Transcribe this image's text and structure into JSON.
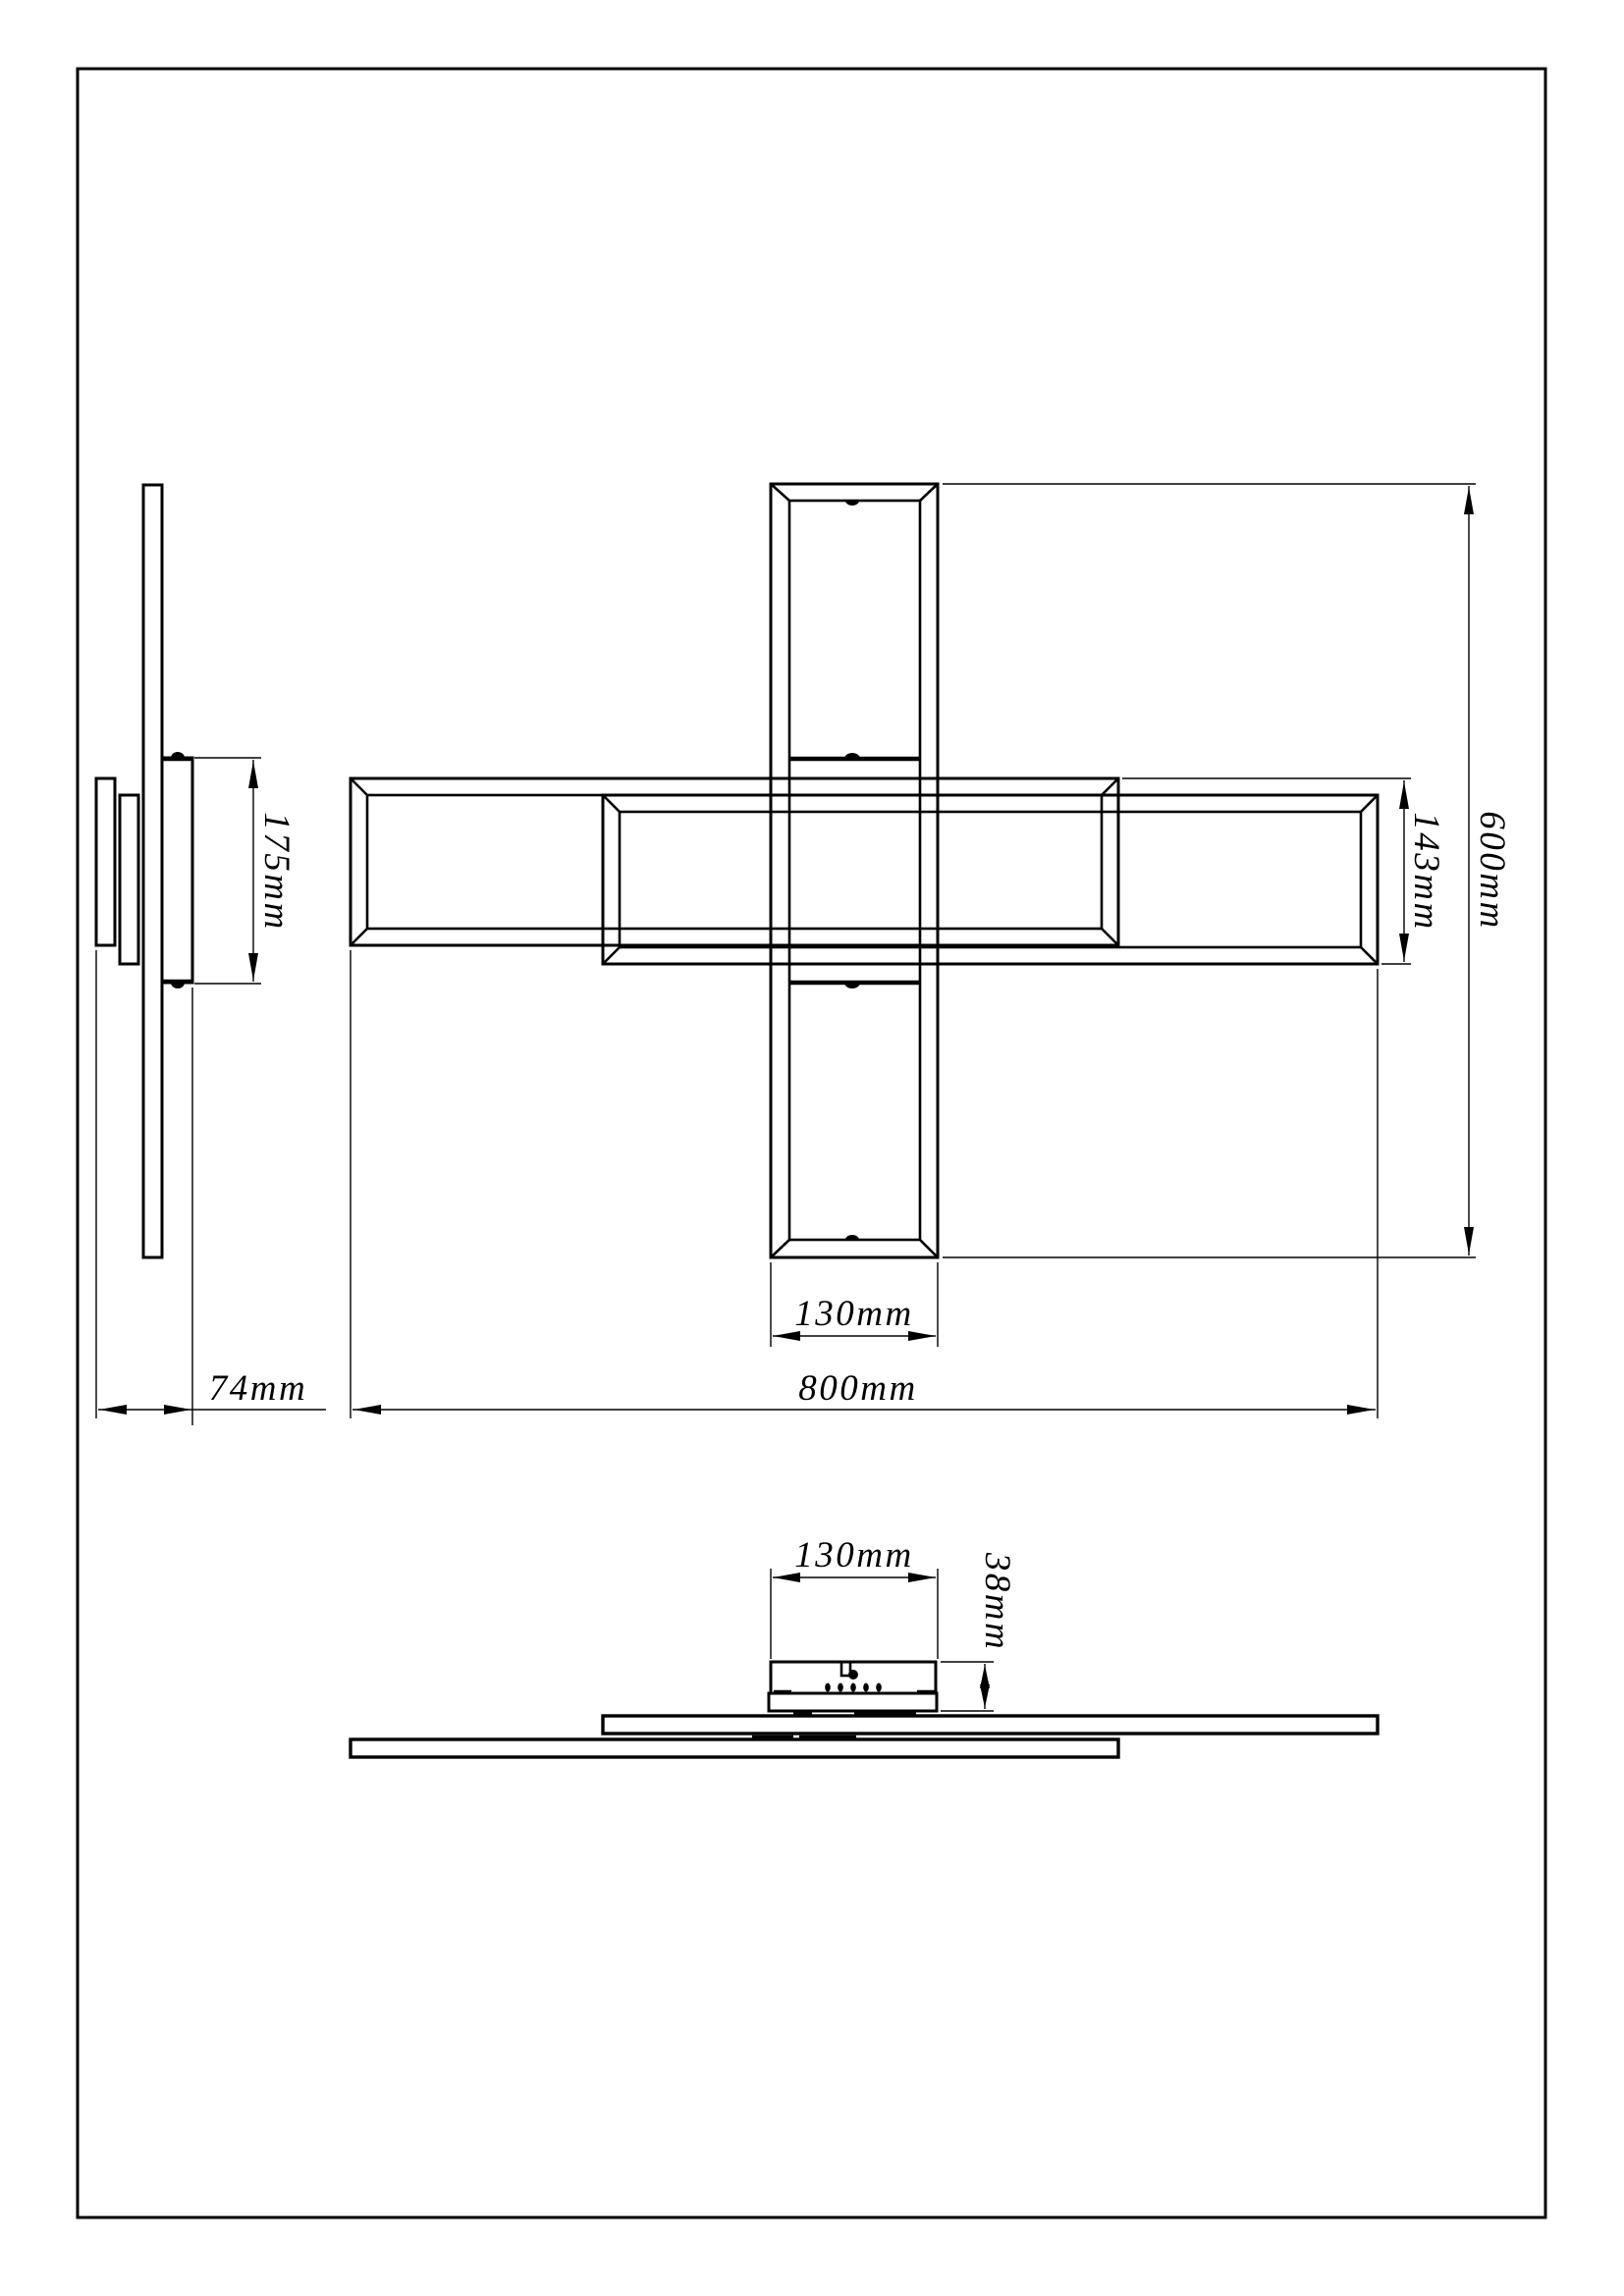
{
  "drawing": {
    "background": "#ffffff",
    "line_color": "#000000",
    "labels": {
      "overall_width": "800mm",
      "overall_height": "600mm",
      "bar_width": "130mm",
      "double_frame_span": "143mm",
      "side_depth": "74mm",
      "side_canopy_span": "175mm",
      "bottom_canopy_width": "130mm",
      "bottom_canopy_height": "38mm"
    }
  }
}
